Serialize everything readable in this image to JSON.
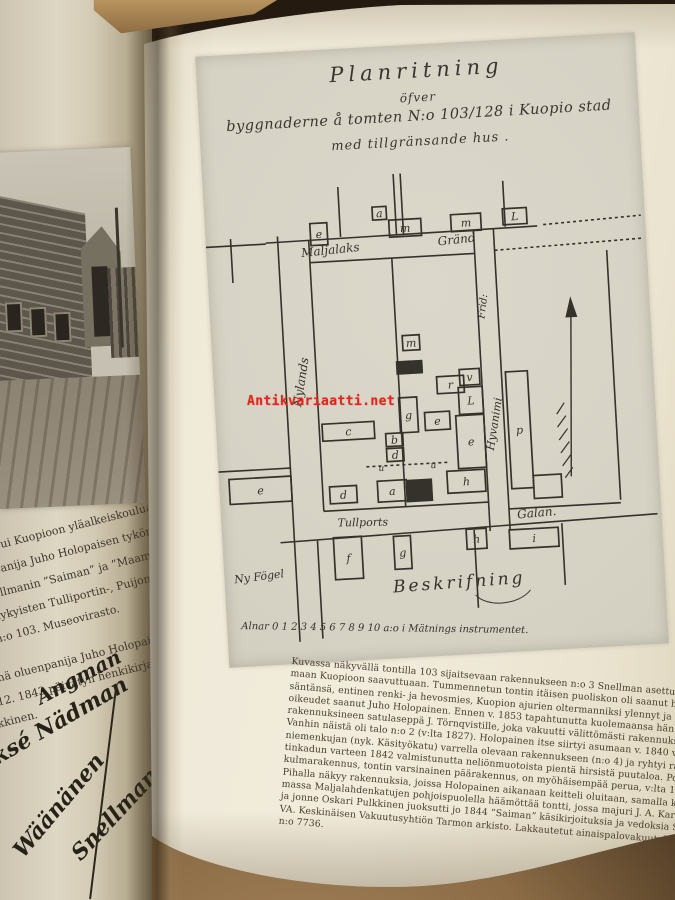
{
  "watermark": {
    "text": "Antikvariaatti.net",
    "color": "#dc291d"
  },
  "page_number": "15",
  "left_page": {
    "fragments": [
      "pui Kuopioon yläalkeiskoulua",
      "panija Juho Holopaisen tykönä",
      "ellmanin ”Saiman” ja ”Maamieh",
      "nykyisten Tulliportin-, Puijon- M",
      "n:o 103. Museovirasto.",
      "nä oluenpanija Juho Holopaisen talo",
      "12. 1843 päivätyn henkikirjan",
      "kkinen."
    ],
    "signatures": [
      "Angman",
      "Jaksé Nädman",
      "Wäänänen",
      "Snellman"
    ]
  },
  "figure": {
    "title_lines": [
      "Planritning",
      "öfver",
      "byggnaderne å tomten N:o 103/128 i Kuopio stad",
      "med tillgränsande hus ."
    ],
    "map": {
      "ink": "#35322b",
      "lines": [
        [
          135,
          10,
          135,
          60
        ],
        [
          191,
          0,
          191,
          61
        ],
        [
          198,
          0,
          198,
          61
        ],
        [
          300,
          13,
          300,
          59
        ],
        [
          25,
          56,
          25,
          100
        ],
        [
          0,
          63,
          60,
          63
        ],
        [
          60,
          62,
          332,
          60
        ],
        [
          338,
          59,
          436,
          55,
          1
        ],
        [
          103,
          84,
          268,
          84
        ],
        [
          288,
          82,
          436,
          78,
          1
        ],
        [
          72,
          56,
          72,
          462
        ],
        [
          103,
          62,
          103,
          333
        ],
        [
          185,
          84,
          185,
          333
        ],
        [
          268,
          60,
          268,
          362
        ],
        [
          288,
          60,
          288,
          362
        ],
        [
          0,
          288,
          72,
          288
        ],
        [
          103,
          333,
          268,
          333
        ],
        [
          288,
          341,
          400,
          341
        ],
        [
          400,
          88,
          400,
          338
        ],
        [
          58,
          362,
          436,
          354
        ],
        [
          95,
          362,
          95,
          460
        ],
        [
          252,
          360,
          252,
          438
        ],
        [
          340,
          358,
          340,
          420
        ],
        [
          148,
          291,
          232,
          291,
          1
        ]
      ],
      "buildings": [
        {
          "x": 105,
          "y": 45,
          "w": 17,
          "h": 22,
          "t": "e"
        },
        {
          "x": 184,
          "y": 46,
          "w": 32,
          "h": 17,
          "t": "m"
        },
        {
          "x": 246,
          "y": 44,
          "w": 30,
          "h": 17,
          "t": "m"
        },
        {
          "x": 298,
          "y": 41,
          "w": 24,
          "h": 16,
          "t": "L"
        },
        {
          "x": 168,
          "y": 32,
          "w": 14,
          "h": 13,
          "t": "a"
        },
        {
          "x": 10,
          "y": 296,
          "w": 62,
          "h": 25,
          "t": "e"
        },
        {
          "x": 106,
          "y": 246,
          "w": 52,
          "h": 17,
          "t": "c"
        },
        {
          "x": 110,
          "y": 309,
          "w": 27,
          "h": 17,
          "t": "d"
        },
        {
          "x": 158,
          "y": 306,
          "w": 29,
          "h": 21,
          "t": "a"
        },
        {
          "x": 187,
          "y": 307,
          "w": 25,
          "h": 21,
          "t": "b",
          "f": 1
        },
        {
          "x": 228,
          "y": 300,
          "w": 38,
          "h": 22,
          "t": "h"
        },
        {
          "x": 184,
          "y": 224,
          "w": 18,
          "h": 35,
          "t": "g"
        },
        {
          "x": 209,
          "y": 240,
          "w": 25,
          "h": 18,
          "t": "e"
        },
        {
          "x": 191,
          "y": 162,
          "w": 17,
          "h": 15,
          "t": "m"
        },
        {
          "x": 184,
          "y": 188,
          "w": 12,
          "h": 12,
          "t": "",
          "f": 1
        },
        {
          "x": 197,
          "y": 188,
          "w": 12,
          "h": 12,
          "t": "",
          "f": 1
        },
        {
          "x": 223,
          "y": 205,
          "w": 27,
          "h": 17,
          "t": "r"
        },
        {
          "x": 169,
          "y": 259,
          "w": 17,
          "h": 13,
          "t": "b"
        },
        {
          "x": 169,
          "y": 274,
          "w": 17,
          "h": 13,
          "t": "d"
        },
        {
          "x": 246,
          "y": 199,
          "w": 20,
          "h": 16,
          "t": "v"
        },
        {
          "x": 244,
          "y": 217,
          "w": 24,
          "h": 27,
          "t": "L"
        },
        {
          "x": 240,
          "y": 245,
          "w": 28,
          "h": 53,
          "t": "e"
        },
        {
          "x": 292,
          "y": 204,
          "w": 22,
          "h": 117,
          "t": "p"
        },
        {
          "x": 314,
          "y": 309,
          "w": 28,
          "h": 23,
          "t": ""
        },
        {
          "x": 287,
          "y": 362,
          "w": 49,
          "h": 19,
          "t": "i"
        },
        {
          "x": 111,
          "y": 360,
          "w": 28,
          "h": 42,
          "t": "f"
        },
        {
          "x": 171,
          "y": 362,
          "w": 17,
          "h": 33,
          "t": "g"
        },
        {
          "x": 244,
          "y": 359,
          "w": 20,
          "h": 20,
          "t": "h"
        }
      ],
      "labels": [
        {
          "t": "Maljalaks",
          "x": 95,
          "y": 78,
          "r": -3,
          "s": 12
        },
        {
          "t": "Gränd",
          "x": 232,
          "y": 74,
          "r": -3,
          "s": 12
        },
        {
          "t": "Nylands",
          "x": 86,
          "y": 228,
          "r": -78,
          "s": 12
        },
        {
          "t": "Frid:",
          "x": 274,
          "y": 150,
          "r": -80,
          "s": 10
        },
        {
          "t": "Hyvanimi",
          "x": 276,
          "y": 282,
          "r": -78,
          "s": 11
        },
        {
          "t": "Tullports",
          "x": 116,
          "y": 349,
          "r": 2,
          "s": 11
        },
        {
          "t": "Galan.",
          "x": 296,
          "y": 351,
          "r": -2,
          "s": 12
        },
        {
          "t": "Ny Fögel",
          "x": 10,
          "y": 400,
          "r": -4,
          "s": 11
        },
        {
          "t": "u",
          "x": 160,
          "y": 296,
          "r": 0,
          "s": 9
        },
        {
          "t": "u",
          "x": 212,
          "y": 296,
          "r": 0,
          "s": 9
        },
        {
          "t": "Beskrifning",
          "x": 168,
          "y": 418,
          "r": -1,
          "s": 17,
          "ls": 3
        },
        {
          "t": "Alnar  0 1 2 3 4 5 6 7 8 9 10   a:o i Mätnings instrumentet.",
          "x": 14,
          "y": 446,
          "r": 4,
          "s": 10
        }
      ],
      "north_arrow": {
        "x1": 352,
        "y1": 312,
        "x2": 361,
        "y2": 144
      }
    }
  },
  "caption": {
    "lines": [
      "Kuvassa näkyvällä tontilla 103 sijaitsevaan rakennukseen n:o 3 Snellman asettui varhaissyksyllä 1843 asu-",
      "maan Kuopioon saavuttuaan. Tummennetun tontin itäisen puoliskon oli saanut haltuunsa hänen vuokrai-",
      "säntänsä, entinen renki- ja hevosmies, Kuopion ajurien oltermanniksi ylennyt ja 1840 oluenpanijaporvarin-",
      "oikeudet saanut Juho Holopainen. Ennen v. 1853 tapahtunutta kuolemaansa hän myi omistamansa tontin",
      "rakennuksineen satulaseppä J. Törnqvistille, joka vakuutti välittömästi rakennuksensa.",
      "Vanhin näistä oli talo n:o 2 (v:lta 1827). Holopainen itse siirtyi asumaan v. 1840 valmistuneeseen Haapa-",
      "niemenkujan (nyk. Käsityökatu) varrella olevaan rakennukseen (n:o 4) ja ryhtyi rakennuttamaan Tullipor-",
      "tinkadun varteen 1842 valmistunutta neliönmuotoista pientä hirsistä puutaloa. Portin itäpuolella näkyvä",
      "kulmarakennus, tontin varsinainen päärakennus, on myöhäisempää perua, v:lta 1852.",
      "Pihalla näkyy rakennuksia, joissa Holopainen aikanaan keitteli oluitaan, samalla kun tontin koilliskul-",
      "massa Maljalahdenkatujen pohjoispuolella häämöttää tontti, jossa majuri J. A. Karstenin kirjapaino sijaitsi",
      "ja jonne Oskari Pulkkinen juoksutti jo 1844 ”Saiman” käsikirjoituksia ja vedoksia Snellmanin työhuoneesta.",
      "VA. Keskinäisen Vakuutusyhtiön Tarmon arkisto. Lakkautetut ainaispalovakuutukset. Kansio 114 (Kuopio",
      "n:o 7736."
    ]
  }
}
